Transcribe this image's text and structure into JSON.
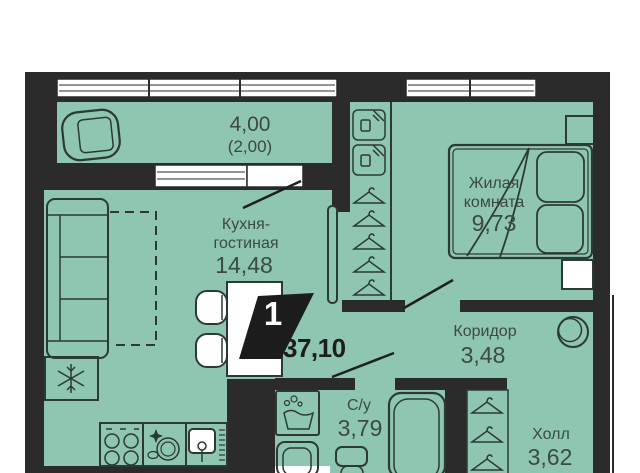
{
  "badge": {
    "number": "1",
    "total_area": "37,10"
  },
  "rooms": {
    "balcony": {
      "area": "4,00",
      "area_reduced": "(2,00)"
    },
    "kitchen_living": {
      "name_line1": "Кухня-",
      "name_line2": "гостиная",
      "area": "14,48"
    },
    "living_room": {
      "name_line1": "Жилая",
      "name_line2": "комната",
      "area": "9,73"
    },
    "corridor": {
      "name": "Коридор",
      "area": "3,48"
    },
    "bathroom": {
      "name": "С/у",
      "area": "3,79"
    },
    "hall": {
      "name": "Холл",
      "area": "3,62"
    }
  },
  "colors": {
    "room_fill": "#8ec6b2",
    "wall": "#2b2b2b",
    "furniture_outline": "#2c3a34",
    "label_text": "#3b4a43",
    "badge_background": "#1c1c1c",
    "badge_text": "#ffffff",
    "window_fill": "#ffffff",
    "background": "#ffffff"
  },
  "icons": [
    "armchair-icon",
    "sofa-icon",
    "snowflake-icon",
    "stove-icon",
    "dishwasher-icon",
    "sink-icon",
    "table-icon",
    "chair-icon",
    "storage-box-icon",
    "hanger-icon",
    "bed-icon",
    "pillow-icon",
    "washing-machine-icon",
    "bathroom-sink-icon",
    "toilet-icon",
    "bathtub-icon",
    "mirror-circle-icon",
    "door-leaf-icon",
    "door-swing-icon",
    "window-icon",
    "shaft-icon"
  ]
}
